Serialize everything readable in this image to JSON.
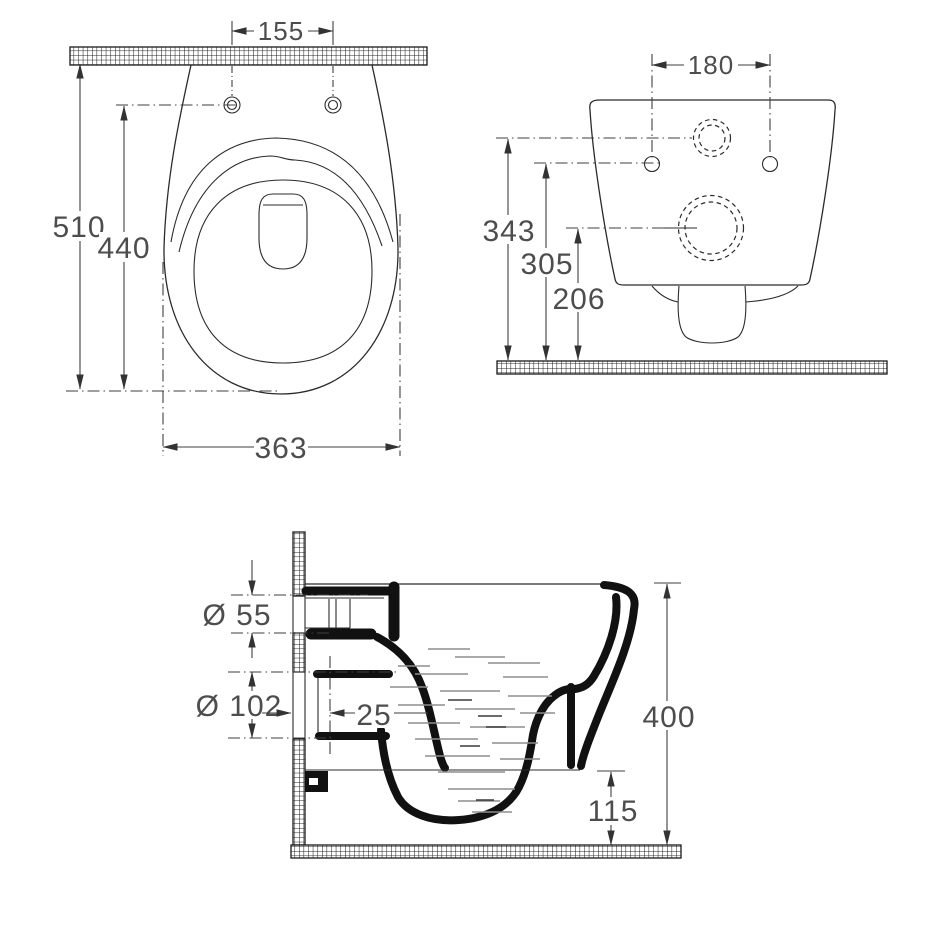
{
  "colors": {
    "background": "#ffffff",
    "line": "#2b2b2b",
    "thick_section": "#111111",
    "dimension_text": "#4d4d4d",
    "water_dashes": "#8e8e8e"
  },
  "plan_view": {
    "d155": "155",
    "d510": "510",
    "d440": "440",
    "d363": "363"
  },
  "rear_view": {
    "d180": "180",
    "d343": "343",
    "d305": "305",
    "d206": "206"
  },
  "section_view": {
    "d55": "Ø 55",
    "d102": "Ø 102",
    "d25": "25",
    "d400": "400",
    "d115": "115"
  }
}
